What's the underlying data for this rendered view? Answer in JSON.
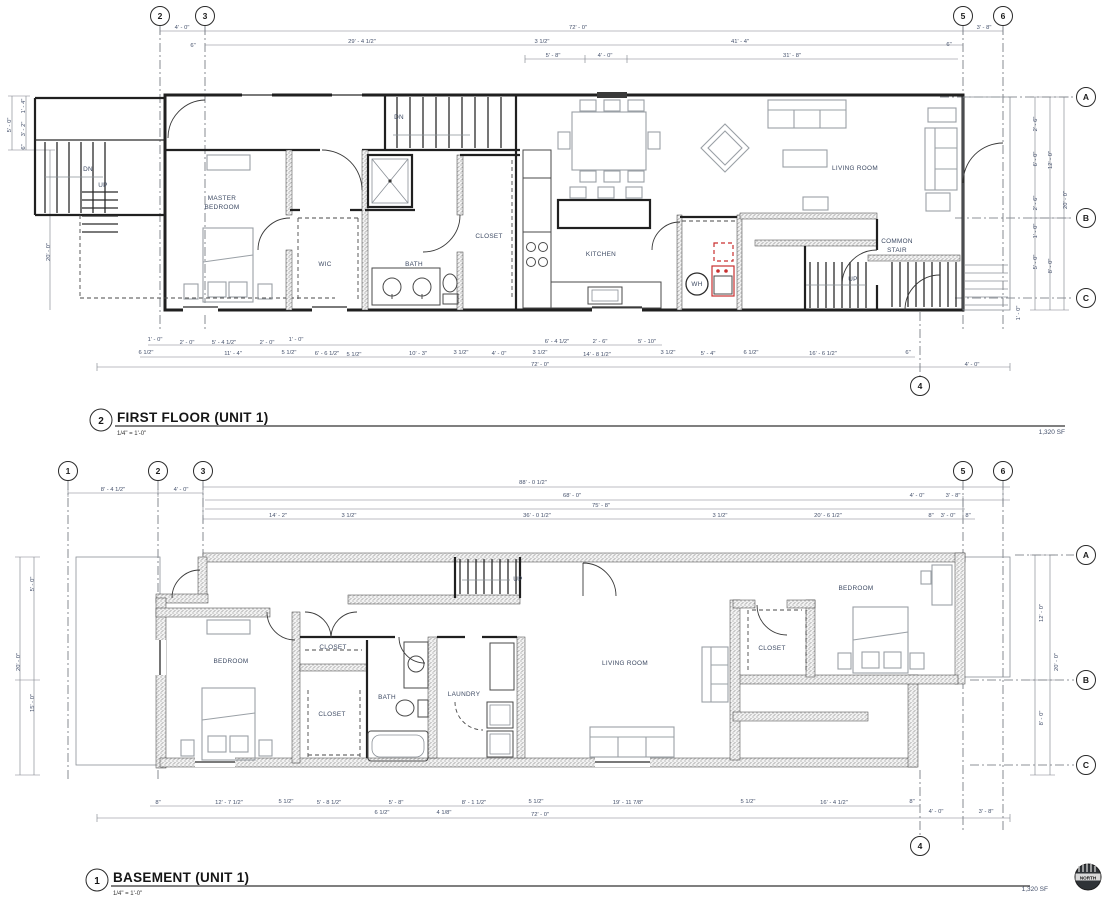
{
  "colors": {
    "wall": "#202020",
    "furniture": "#9aa0a6",
    "dim_text": "#44506b",
    "label_text": "#3d4a63",
    "accent_red": "#c92f2f"
  },
  "first_floor": {
    "number": "2",
    "title": "FIRST FLOOR (UNIT 1)",
    "scale": "1/4\" = 1'-0\"",
    "area": "1,320 SF",
    "bubbles": [
      {
        "t": "2",
        "x": 160,
        "y": 16
      },
      {
        "t": "3",
        "x": 205,
        "y": 16
      },
      {
        "t": "5",
        "x": 963,
        "y": 16
      },
      {
        "t": "6",
        "x": 1003,
        "y": 16
      },
      {
        "t": "A",
        "x": 1086,
        "y": 97
      },
      {
        "t": "B",
        "x": 1086,
        "y": 218
      },
      {
        "t": "C",
        "x": 1086,
        "y": 298
      },
      {
        "t": "4",
        "x": 920,
        "y": 386
      }
    ],
    "room_labels": [
      {
        "t": "MASTER",
        "x": 222,
        "y": 200
      },
      {
        "t": "BEDROOM",
        "x": 222,
        "y": 209
      },
      {
        "t": "WIC",
        "x": 325,
        "y": 266
      },
      {
        "t": "BATH",
        "x": 414,
        "y": 266
      },
      {
        "t": "CLOSET",
        "x": 489,
        "y": 238
      },
      {
        "t": "KITCHEN",
        "x": 601,
        "y": 256
      },
      {
        "t": "LIVING ROOM",
        "x": 855,
        "y": 170
      },
      {
        "t": "COMMON",
        "x": 897,
        "y": 243
      },
      {
        "t": "STAIR",
        "x": 897,
        "y": 252
      },
      {
        "t": "WH",
        "x": 697,
        "y": 286
      },
      {
        "t": "DN",
        "x": 399,
        "y": 119
      },
      {
        "t": "DN",
        "x": 88,
        "y": 171
      },
      {
        "t": "UP",
        "x": 103,
        "y": 187
      },
      {
        "t": "UP",
        "x": 853,
        "y": 281
      }
    ],
    "dims": [
      {
        "t": "4' - 0\"",
        "x": 182,
        "y": 29
      },
      {
        "t": "72' - 0\"",
        "x": 578,
        "y": 29
      },
      {
        "t": "3' - 8\"",
        "x": 984,
        "y": 29
      },
      {
        "t": "6\"",
        "x": 193,
        "y": 47
      },
      {
        "t": "29' - 4 1/2\"",
        "x": 362,
        "y": 43
      },
      {
        "t": "3 1/2\"",
        "x": 542,
        "y": 43
      },
      {
        "t": "41' - 4\"",
        "x": 740,
        "y": 43
      },
      {
        "t": "6\"",
        "x": 949,
        "y": 46
      },
      {
        "t": "5' - 8\"",
        "x": 553,
        "y": 57
      },
      {
        "t": "4' - 0\"",
        "x": 605,
        "y": 57
      },
      {
        "t": "31' - 8\"",
        "x": 792,
        "y": 57
      },
      {
        "t": "5' - 0\"",
        "x": 11,
        "y": 125,
        "r": -90
      },
      {
        "t": "1' - 4\"",
        "x": 25,
        "y": 106,
        "r": -90
      },
      {
        "t": "3' - 2\"",
        "x": 25,
        "y": 129,
        "r": -90
      },
      {
        "t": "6\"",
        "x": 25,
        "y": 147,
        "r": -90
      },
      {
        "t": "20' - 0\"",
        "x": 50,
        "y": 252,
        "r": -90
      },
      {
        "t": "2' - 6\"",
        "x": 1037,
        "y": 124,
        "r": -90
      },
      {
        "t": "6' - 0\"",
        "x": 1037,
        "y": 159,
        "r": -90
      },
      {
        "t": "2' - 6\"",
        "x": 1037,
        "y": 203,
        "r": -90
      },
      {
        "t": "1' - 0\"",
        "x": 1037,
        "y": 231,
        "r": -90
      },
      {
        "t": "5' - 0\"",
        "x": 1037,
        "y": 262,
        "r": -90
      },
      {
        "t": "12' - 0\"",
        "x": 1052,
        "y": 160,
        "r": -90
      },
      {
        "t": "8' - 0\"",
        "x": 1052,
        "y": 266,
        "r": -90
      },
      {
        "t": "20' - 0\"",
        "x": 1067,
        "y": 200,
        "r": -90
      },
      {
        "t": "1' - 0\"",
        "x": 1020,
        "y": 313,
        "r": -90
      },
      {
        "t": "1' - 0\"",
        "x": 155,
        "y": 341
      },
      {
        "t": "2' - 0\"",
        "x": 187,
        "y": 344
      },
      {
        "t": "5' - 4 1/2\"",
        "x": 224,
        "y": 344
      },
      {
        "t": "2' - 0\"",
        "x": 267,
        "y": 344
      },
      {
        "t": "1' - 0\"",
        "x": 296,
        "y": 341
      },
      {
        "t": "6' - 4 1/2\"",
        "x": 557,
        "y": 343
      },
      {
        "t": "2' - 6\"",
        "x": 600,
        "y": 343
      },
      {
        "t": "5' - 10\"",
        "x": 647,
        "y": 343
      },
      {
        "t": "6 1/2\"",
        "x": 146,
        "y": 354
      },
      {
        "t": "11' - 4\"",
        "x": 233,
        "y": 355
      },
      {
        "t": "5 1/2\"",
        "x": 289,
        "y": 354
      },
      {
        "t": "6' - 6 1/2\"",
        "x": 327,
        "y": 355
      },
      {
        "t": "5 1/2\"",
        "x": 354,
        "y": 356
      },
      {
        "t": "10' - 3\"",
        "x": 418,
        "y": 355
      },
      {
        "t": "3 1/2\"",
        "x": 461,
        "y": 354
      },
      {
        "t": "4' - 0\"",
        "x": 499,
        "y": 355
      },
      {
        "t": "3 1/2\"",
        "x": 540,
        "y": 354
      },
      {
        "t": "14' - 8 1/2\"",
        "x": 597,
        "y": 356
      },
      {
        "t": "3 1/2\"",
        "x": 668,
        "y": 354
      },
      {
        "t": "5' - 4\"",
        "x": 708,
        "y": 355
      },
      {
        "t": "6 1/2\"",
        "x": 751,
        "y": 354
      },
      {
        "t": "16' - 6 1/2\"",
        "x": 823,
        "y": 355
      },
      {
        "t": "6\"",
        "x": 908,
        "y": 354
      },
      {
        "t": "72' - 0\"",
        "x": 540,
        "y": 366
      },
      {
        "t": "4' - 0\"",
        "x": 972,
        "y": 366
      }
    ]
  },
  "basement": {
    "number": "1",
    "title": "BASEMENT (UNIT 1)",
    "scale": "1/4\" = 1'-0\"",
    "area": "1,320 SF",
    "bubbles": [
      {
        "t": "1",
        "x": 68,
        "y": 471
      },
      {
        "t": "2",
        "x": 158,
        "y": 471
      },
      {
        "t": "3",
        "x": 203,
        "y": 471
      },
      {
        "t": "5",
        "x": 963,
        "y": 471
      },
      {
        "t": "6",
        "x": 1003,
        "y": 471
      },
      {
        "t": "A",
        "x": 1086,
        "y": 555
      },
      {
        "t": "B",
        "x": 1086,
        "y": 680
      },
      {
        "t": "C",
        "x": 1086,
        "y": 765
      },
      {
        "t": "4",
        "x": 920,
        "y": 846
      }
    ],
    "room_labels": [
      {
        "t": "BEDROOM",
        "x": 231,
        "y": 663
      },
      {
        "t": "CLOSET",
        "x": 333,
        "y": 649
      },
      {
        "t": "CLOSET",
        "x": 332,
        "y": 716
      },
      {
        "t": "BATH",
        "x": 387,
        "y": 699
      },
      {
        "t": "LAUNDRY",
        "x": 464,
        "y": 696
      },
      {
        "t": "LIVING ROOM",
        "x": 625,
        "y": 665
      },
      {
        "t": "CLOSET",
        "x": 772,
        "y": 650
      },
      {
        "t": "BEDROOM",
        "x": 856,
        "y": 590
      },
      {
        "t": "UP",
        "x": 518,
        "y": 581
      }
    ],
    "dims": [
      {
        "t": "8' - 4 1/2\"",
        "x": 113,
        "y": 491
      },
      {
        "t": "4' - 0\"",
        "x": 181,
        "y": 491
      },
      {
        "t": "88' - 0 1/2\"",
        "x": 533,
        "y": 484
      },
      {
        "t": "68' - 0\"",
        "x": 572,
        "y": 497
      },
      {
        "t": "4' - 0\"",
        "x": 917,
        "y": 497
      },
      {
        "t": "3' - 8\"",
        "x": 953,
        "y": 497
      },
      {
        "t": "75' - 8\"",
        "x": 601,
        "y": 507
      },
      {
        "t": "14' - 2\"",
        "x": 278,
        "y": 517
      },
      {
        "t": "3 1/2\"",
        "x": 349,
        "y": 517
      },
      {
        "t": "36' - 0 1/2\"",
        "x": 537,
        "y": 517
      },
      {
        "t": "3 1/2\"",
        "x": 720,
        "y": 517
      },
      {
        "t": "20' - 6 1/2\"",
        "x": 828,
        "y": 517
      },
      {
        "t": "8\"",
        "x": 931,
        "y": 517
      },
      {
        "t": "3' - 0\"",
        "x": 948,
        "y": 517
      },
      {
        "t": "8\"",
        "x": 968,
        "y": 517
      },
      {
        "t": "20' - 0\"",
        "x": 20,
        "y": 662,
        "r": -90
      },
      {
        "t": "5' - 0\"",
        "x": 34,
        "y": 584,
        "r": -90
      },
      {
        "t": "15' - 0\"",
        "x": 34,
        "y": 703,
        "r": -90
      },
      {
        "t": "12' - 0\"",
        "x": 1043,
        "y": 613,
        "r": -90
      },
      {
        "t": "20' - 0\"",
        "x": 1058,
        "y": 662,
        "r": -90
      },
      {
        "t": "8' - 0\"",
        "x": 1043,
        "y": 718,
        "r": -90
      },
      {
        "t": "8\"",
        "x": 158,
        "y": 804
      },
      {
        "t": "12' - 7 1/2\"",
        "x": 229,
        "y": 804
      },
      {
        "t": "5 1/2\"",
        "x": 286,
        "y": 803
      },
      {
        "t": "5' - 8 1/2\"",
        "x": 329,
        "y": 804
      },
      {
        "t": "5' - 8\"",
        "x": 396,
        "y": 804
      },
      {
        "t": "8' - 1 1/2\"",
        "x": 474,
        "y": 804
      },
      {
        "t": "5 1/2\"",
        "x": 536,
        "y": 803
      },
      {
        "t": "19' - 11 7/8\"",
        "x": 628,
        "y": 804
      },
      {
        "t": "5 1/2\"",
        "x": 748,
        "y": 803
      },
      {
        "t": "16' - 4 1/2\"",
        "x": 834,
        "y": 804
      },
      {
        "t": "8\"",
        "x": 912,
        "y": 803
      },
      {
        "t": "6 1/2\"",
        "x": 382,
        "y": 814
      },
      {
        "t": "4 1/8\"",
        "x": 444,
        "y": 814
      },
      {
        "t": "72' - 0\"",
        "x": 540,
        "y": 816
      },
      {
        "t": "4' - 0\"",
        "x": 936,
        "y": 813
      },
      {
        "t": "3' - 8\"",
        "x": 986,
        "y": 813
      }
    ]
  },
  "north_badge": {
    "label": "NORTH"
  }
}
